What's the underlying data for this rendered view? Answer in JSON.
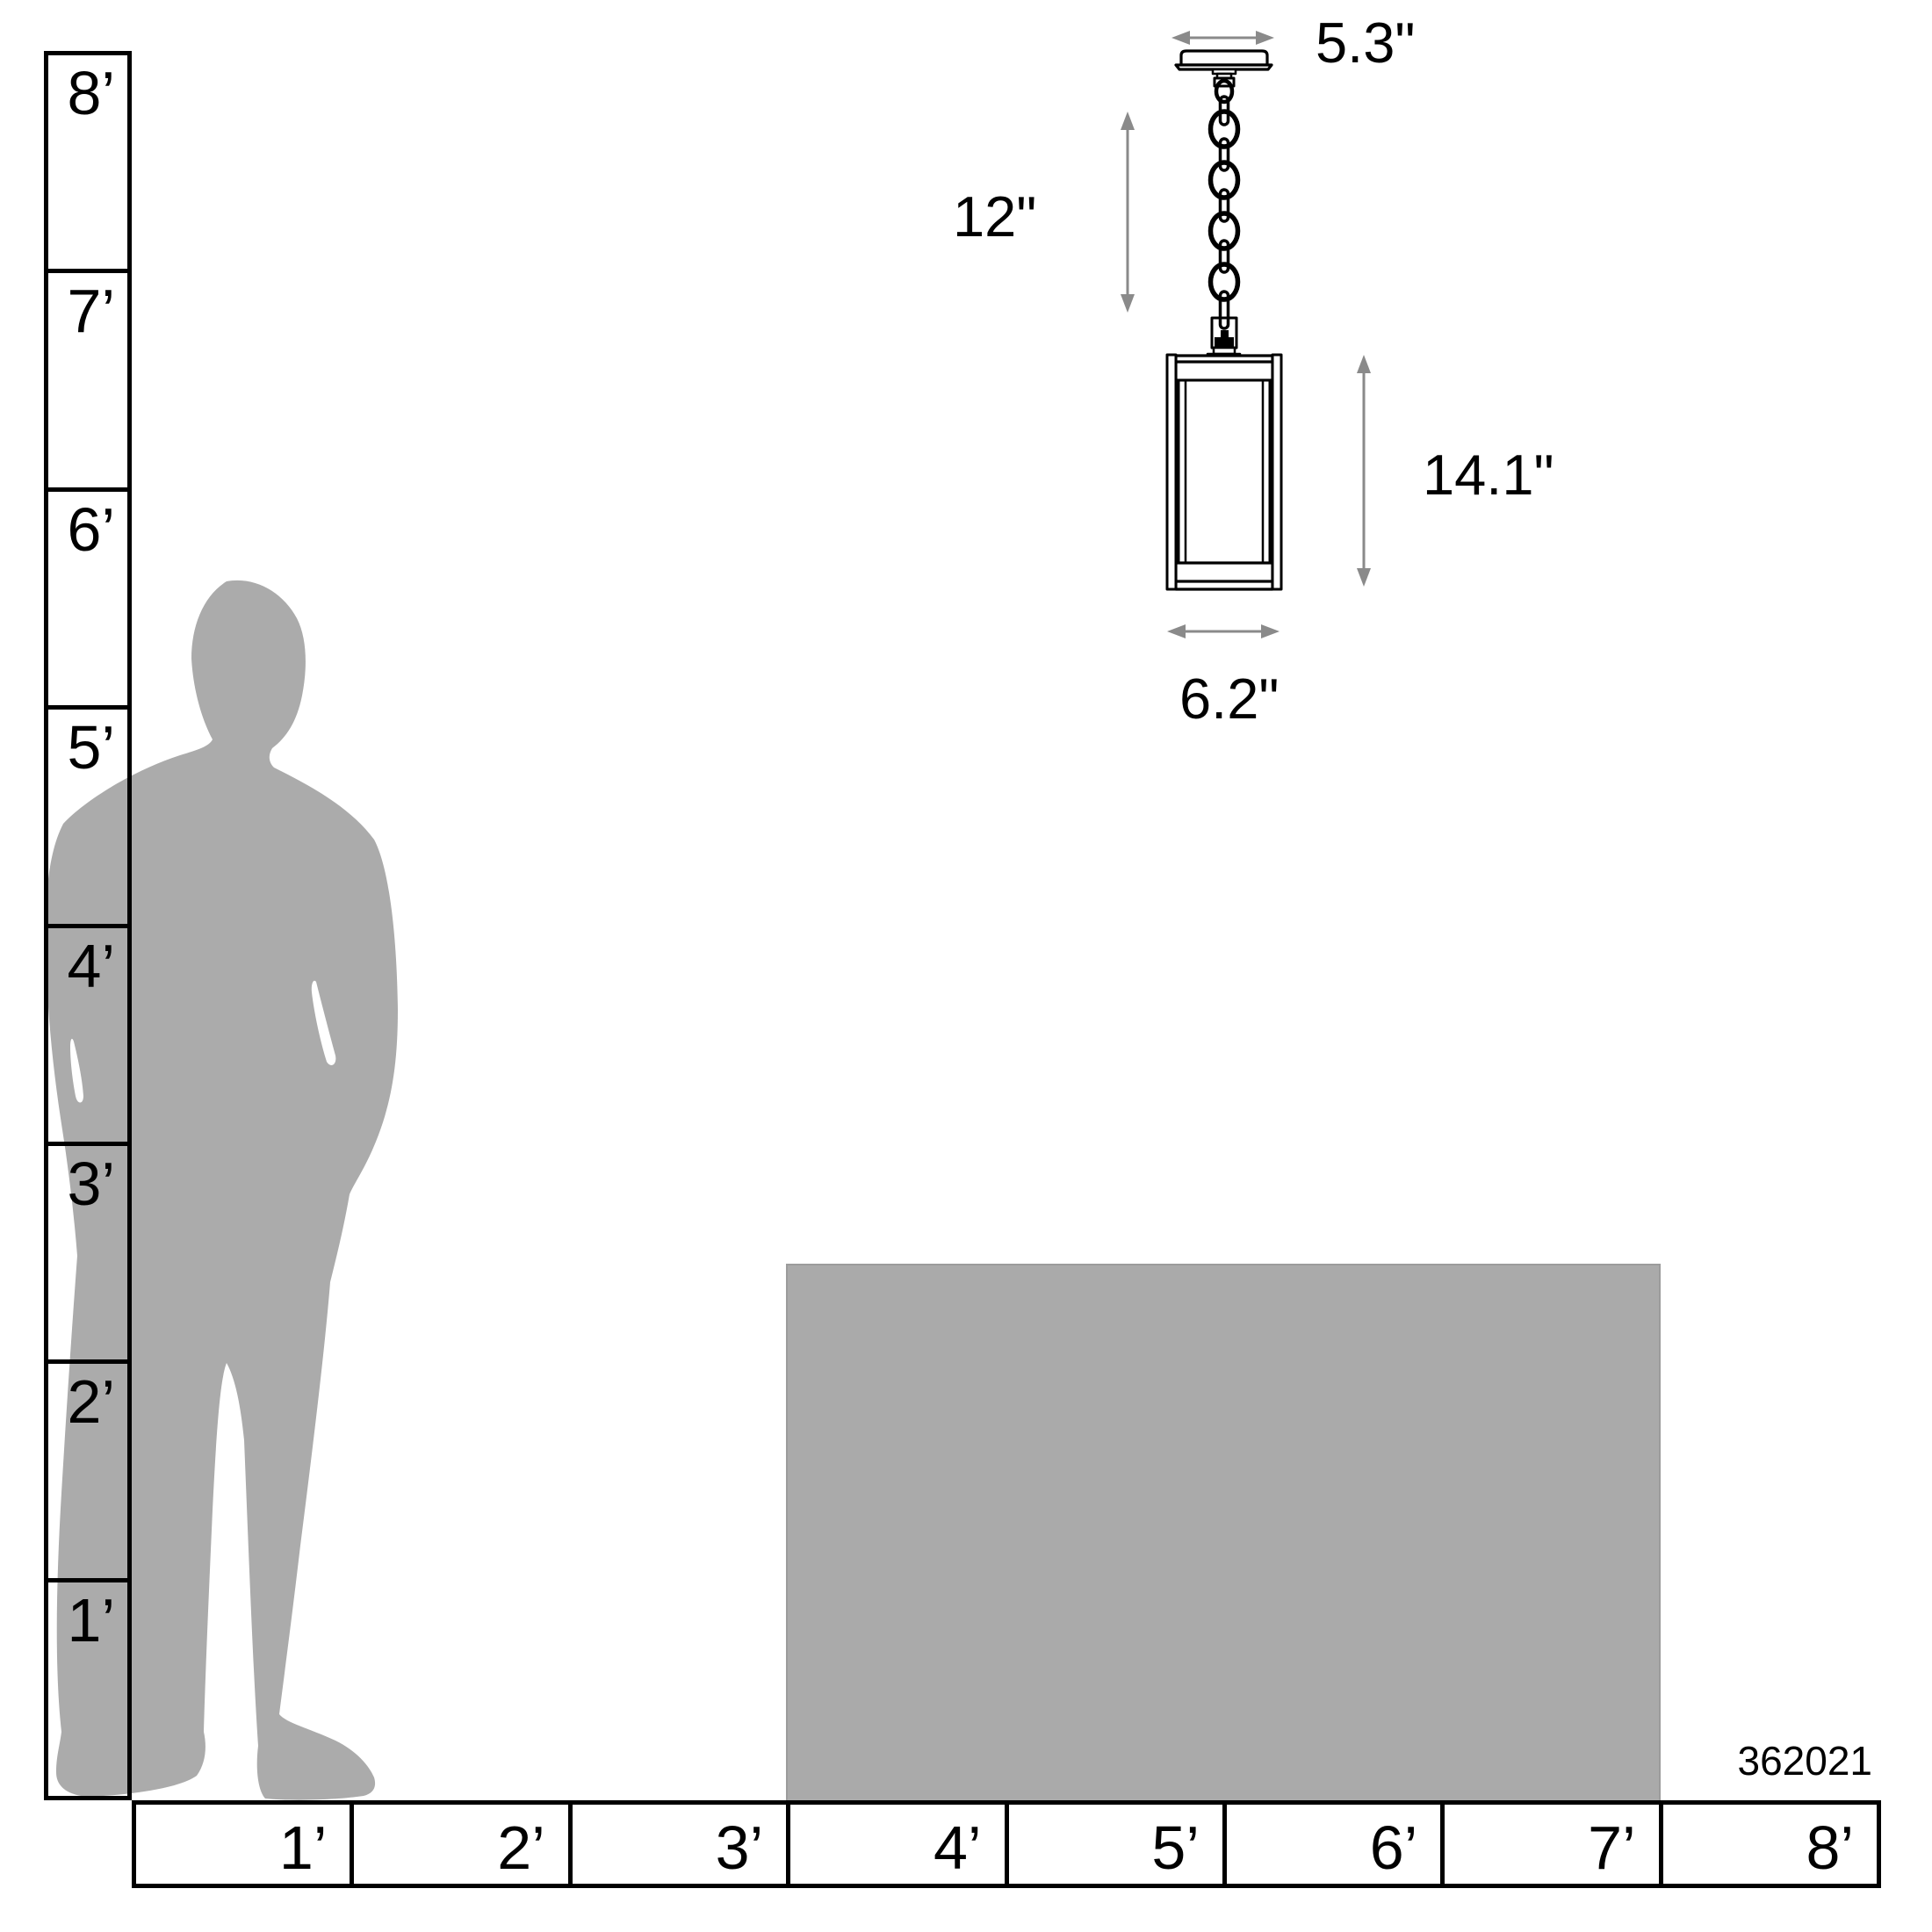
{
  "product": {
    "number": "362021"
  },
  "dimensions": {
    "canopy_width": "5.3\"",
    "chain_length": "12\"",
    "fixture_height": "14.1\"",
    "fixture_width": "6.2\""
  },
  "rulers": {
    "vertical": {
      "unit": "feet",
      "labels": [
        "8’",
        "7’",
        "6’",
        "5’",
        "4’",
        "3’",
        "2’",
        "1’"
      ]
    },
    "horizontal": {
      "unit": "feet",
      "labels": [
        "1’",
        "2’",
        "3’",
        "4’",
        "5’",
        "6’",
        "7’",
        "8’"
      ]
    }
  },
  "colors": {
    "silhouette": "#ababab",
    "furniture": "#aaaaaa",
    "dimension_arrow": "#8a8a8a",
    "line": "#000000"
  }
}
